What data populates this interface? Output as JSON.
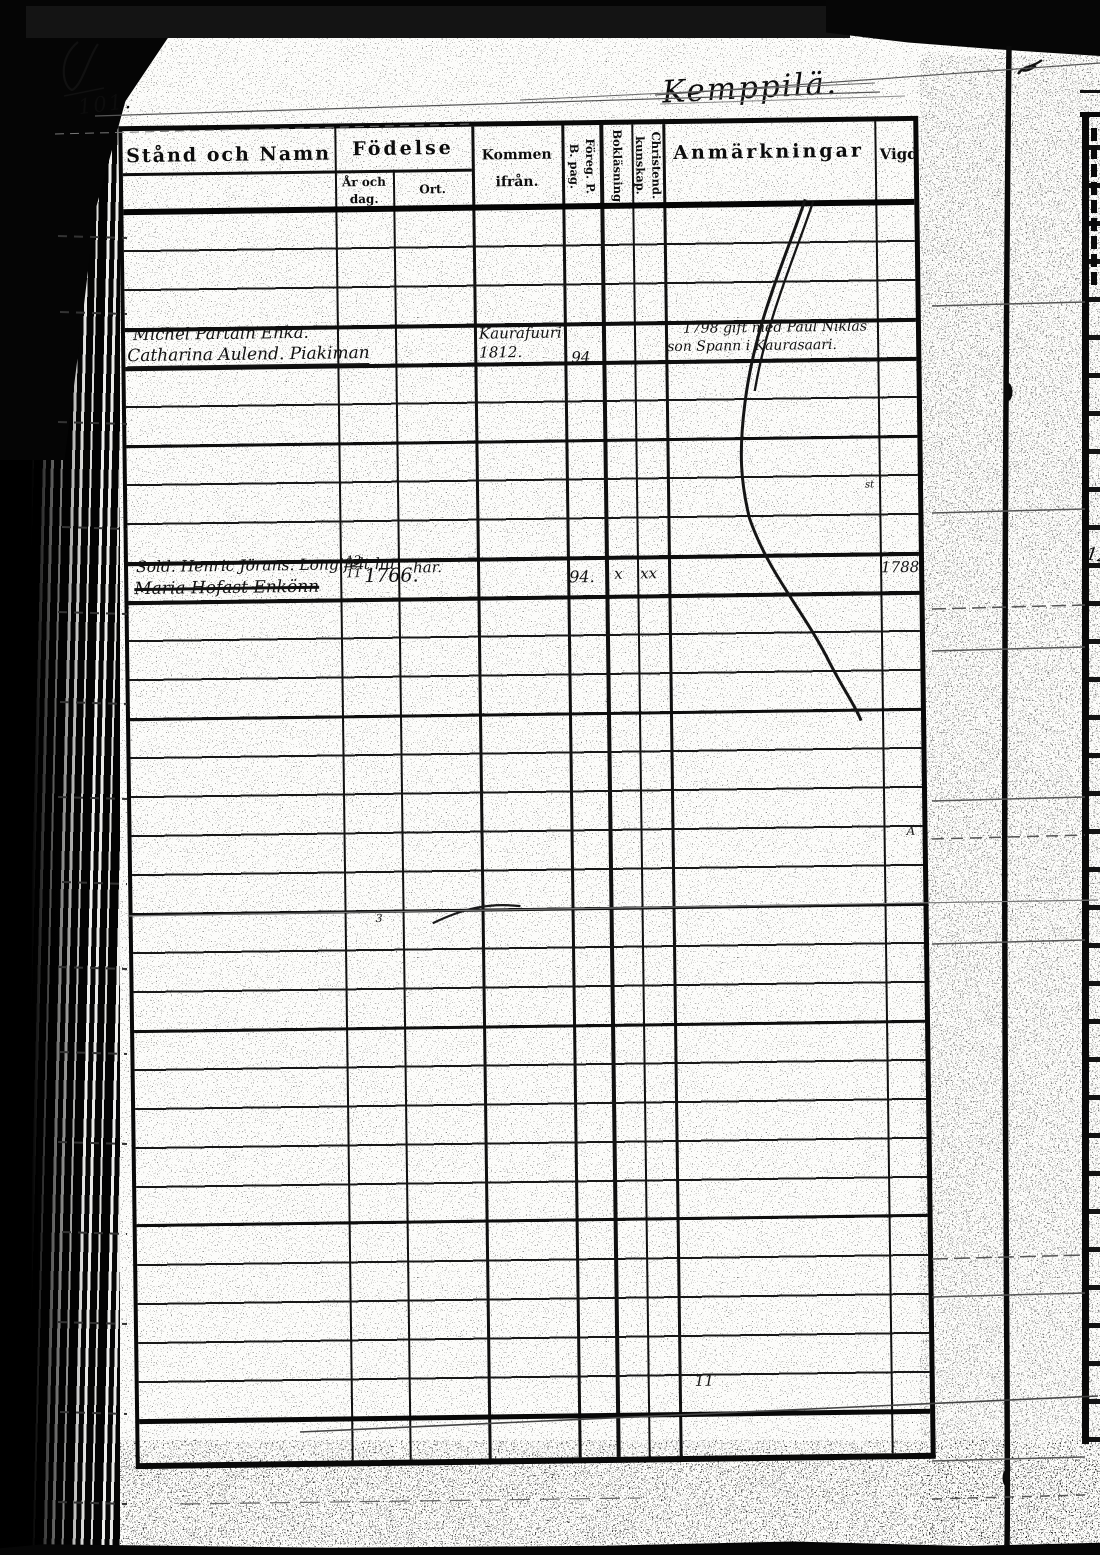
{
  "page": {
    "folio_number": "101.",
    "place_title": "Kemppilä."
  },
  "table": {
    "headers": {
      "col_name": "Stånd och Namn",
      "col_birth": "Födelse",
      "col_birth_sub_date": "År och dag.",
      "col_birth_sub_place": "Ort.",
      "col_come_from": "Kommen ifrån.",
      "col_prev_page": "Föreg. P. B. pag.",
      "col_reading": "Bokläsning",
      "col_christianity": "Christend. kunskap.",
      "col_remarks": "Anmärkningar",
      "col_married": "Vigd"
    },
    "entries": [
      {
        "name_line1": "Michel Partain Enka.",
        "name_line2": "Catharina Aulend. Piakiman",
        "come_from_line1": "Kaurafuuri",
        "come_from_line2": "1812.",
        "prev_page": "94",
        "remarks_line1": "1798 gift med Paul Niklas",
        "remarks_line2": "son Spann i Kaurasaari."
      },
      {
        "name_line1": "Sold. Henric Jörans. Longifelt hu",
        "name_line2": "Maria Hofast Enkönn",
        "birth_day": "12",
        "birth_month": "11",
        "birth_year": "1766.",
        "birth_place": "här.",
        "prev_page": "94.",
        "reading_mark": "x",
        "christianity_mark": "xx",
        "married": "1788."
      }
    ],
    "marks": {
      "row_note": "11",
      "vigd_mark": "A",
      "small_mark": "3",
      "dot_mark": "·",
      "tiny_mark": "st"
    }
  },
  "next_page": {
    "fragment": "12"
  }
}
